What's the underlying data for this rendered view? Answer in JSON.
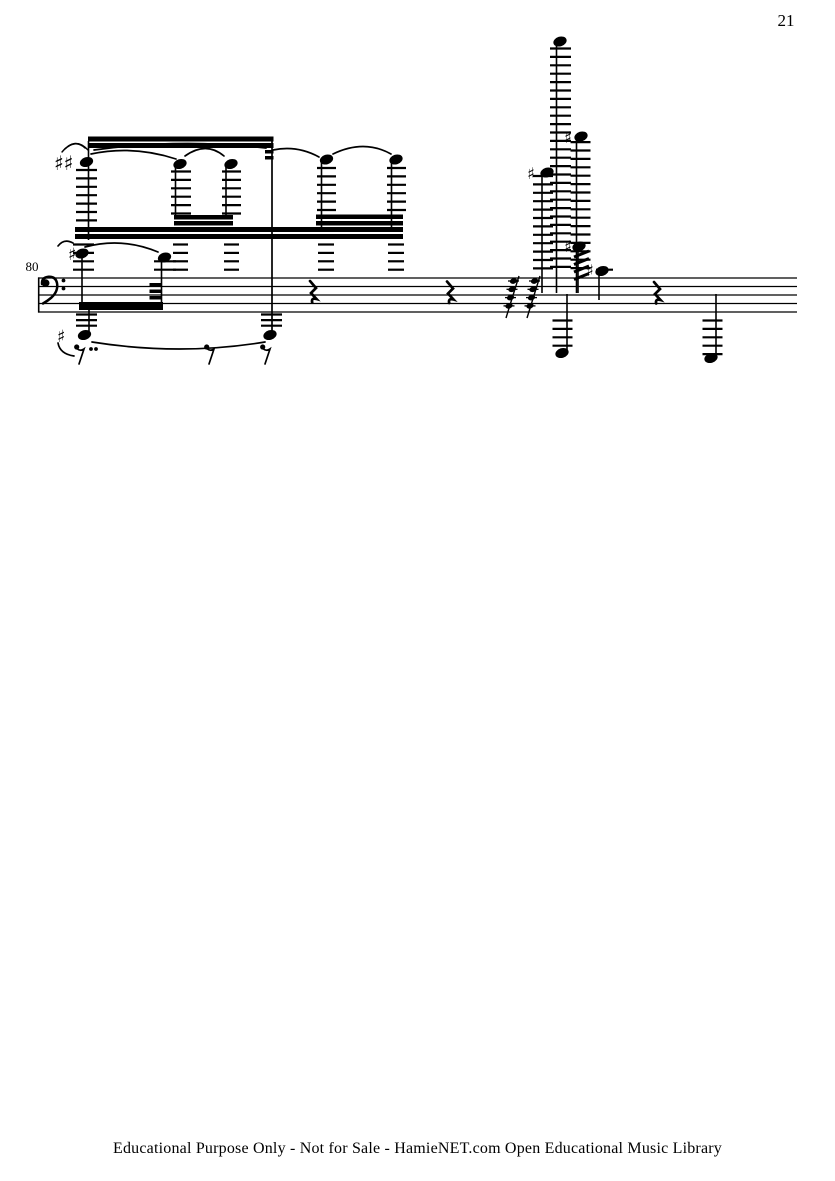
{
  "page": {
    "number": "21",
    "footer": "Educational Purpose Only - Not for Sale - HamieNET.com Open Educational Music Library",
    "background": "#ffffff",
    "ink": "#000000"
  },
  "score": {
    "measure_number": "80",
    "clef": "bass-clef",
    "staff": {
      "x1": 38,
      "x2": 797,
      "line_ys": [
        278,
        286.5,
        295,
        303.5,
        312
      ],
      "lw": 1.2
    },
    "barlines": [
      {
        "x": 38.7,
        "y1": 277.4,
        "y2": 312.6,
        "w": 1.6
      },
      {
        "x": 272,
        "y1": 137,
        "y2": 333,
        "w": 1.7
      }
    ],
    "ladders": [
      {
        "x": 76,
        "w": 21,
        "y1": 170,
        "y2": 221,
        "step": 8.4
      },
      {
        "x": 171,
        "w": 20,
        "y1": 171.5,
        "y2": 214,
        "step": 8.4
      },
      {
        "x": 222,
        "w": 19,
        "y1": 171.5,
        "y2": 214,
        "step": 8.4
      },
      {
        "x": 317,
        "w": 19,
        "y1": 168,
        "y2": 210,
        "step": 8.4
      },
      {
        "x": 387,
        "w": 19,
        "y1": 168,
        "y2": 210,
        "step": 8.4
      },
      {
        "x": 73,
        "w": 21,
        "y1": 244.5,
        "y2": 270,
        "step": 8.4
      },
      {
        "x": 173,
        "w": 15,
        "y1": 244.5,
        "y2": 270,
        "step": 8.4
      },
      {
        "x": 224,
        "w": 15,
        "y1": 244.5,
        "y2": 270,
        "step": 8.4
      },
      {
        "x": 318,
        "w": 16,
        "y1": 244.5,
        "y2": 270,
        "step": 8.4
      },
      {
        "x": 388,
        "w": 16,
        "y1": 244.5,
        "y2": 270,
        "step": 8.4
      },
      {
        "x": 154,
        "w": 22,
        "y1": 261.3,
        "y2": 270,
        "step": 8.4
      },
      {
        "x": 550,
        "w": 21,
        "y1": 48.5,
        "y2": 270,
        "step": 8.4
      },
      {
        "x": 570.5,
        "w": 20,
        "y1": 142.1,
        "y2": 270,
        "step": 8.4
      },
      {
        "x": 533,
        "w": 20,
        "y1": 176,
        "y2": 270,
        "step": 8.4
      },
      {
        "x": 596,
        "w": 17,
        "y1": 269.7,
        "y2": 270,
        "step": 8.4
      },
      {
        "x": 76,
        "w": 21,
        "y1": 314.5,
        "y2": 326,
        "step": 5.6
      },
      {
        "x": 261,
        "w": 21,
        "y1": 314.5,
        "y2": 326,
        "step": 5.6
      },
      {
        "x": 552.5,
        "w": 20,
        "y1": 320.5,
        "y2": 347,
        "step": 8.4
      },
      {
        "x": 702.5,
        "w": 20,
        "y1": 320.5,
        "y2": 355,
        "step": 8.4
      }
    ],
    "stems": [
      {
        "x": 88.5,
        "y1": 141,
        "y2": 240
      },
      {
        "x": 175.5,
        "y1": 166,
        "y2": 217
      },
      {
        "x": 226,
        "y1": 166,
        "y2": 217
      },
      {
        "x": 321.5,
        "y1": 162,
        "y2": 228
      },
      {
        "x": 391.5,
        "y1": 162,
        "y2": 228
      },
      {
        "x": 82,
        "y1": 257,
        "y2": 303
      },
      {
        "x": 161.5,
        "y1": 260,
        "y2": 303
      },
      {
        "x": 89,
        "y1": 307,
        "y2": 331
      },
      {
        "x": 556.5,
        "y1": 44,
        "y2": 293
      },
      {
        "x": 576.5,
        "y1": 140,
        "y2": 293
      },
      {
        "x": 542,
        "y1": 176,
        "y2": 293
      },
      {
        "x": 578,
        "y1": 250,
        "y2": 293
      },
      {
        "x": 599,
        "y1": 274,
        "y2": 300
      },
      {
        "x": 567,
        "y1": 294,
        "y2": 350
      },
      {
        "x": 716,
        "y1": 294,
        "y2": 355
      }
    ],
    "beams": [
      {
        "x": 88,
        "y": 136.5,
        "w": 185.5,
        "h": 5
      },
      {
        "x": 88,
        "y": 143,
        "w": 185.5,
        "h": 5
      },
      {
        "x": 265,
        "y": 150,
        "w": 8.5,
        "h": 3.5
      },
      {
        "x": 265,
        "y": 156,
        "w": 8.5,
        "h": 3.5
      },
      {
        "x": 174,
        "y": 215,
        "w": 59,
        "h": 4.5
      },
      {
        "x": 174,
        "y": 221,
        "w": 59,
        "h": 4.5
      },
      {
        "x": 316,
        "y": 214.5,
        "w": 87,
        "h": 4.5
      },
      {
        "x": 316,
        "y": 221,
        "w": 87,
        "h": 4.5
      },
      {
        "x": 75,
        "y": 227,
        "w": 328,
        "h": 5
      },
      {
        "x": 75,
        "y": 234,
        "w": 328,
        "h": 5
      },
      {
        "x": 79,
        "y": 302,
        "w": 84,
        "h": 8
      },
      {
        "x": 149.5,
        "y": 283,
        "w": 12,
        "h": 3.5
      },
      {
        "x": 149.5,
        "y": 289.5,
        "w": 12,
        "h": 3.5
      },
      {
        "x": 149.5,
        "y": 296,
        "w": 12,
        "h": 3.5
      }
    ],
    "noteheads": [
      {
        "cx": 86.5,
        "cy": 162
      },
      {
        "cx": 180,
        "cy": 164
      },
      {
        "cx": 231,
        "cy": 164
      },
      {
        "cx": 326.5,
        "cy": 159.5
      },
      {
        "cx": 396,
        "cy": 159.5
      },
      {
        "cx": 82,
        "cy": 253.5
      },
      {
        "cx": 164.5,
        "cy": 257.5
      },
      {
        "cx": 84.5,
        "cy": 335
      },
      {
        "cx": 270,
        "cy": 335
      },
      {
        "cx": 560,
        "cy": 41.5
      },
      {
        "cx": 581,
        "cy": 136.5
      },
      {
        "cx": 547,
        "cy": 172.5
      },
      {
        "cx": 579,
        "cy": 246.5
      },
      {
        "cx": 602,
        "cy": 271
      },
      {
        "cx": 562,
        "cy": 353
      },
      {
        "cx": 711,
        "cy": 358
      }
    ],
    "accidentals": [
      {
        "glyph": "♯♯",
        "x": 54,
        "y": 170,
        "size": 20
      },
      {
        "glyph": "♯",
        "x": 68,
        "y": 260,
        "size": 17
      },
      {
        "glyph": "♯",
        "x": 57,
        "y": 342,
        "size": 17
      },
      {
        "glyph": "♯",
        "x": 564,
        "y": 143,
        "size": 16
      },
      {
        "glyph": "♯",
        "x": 527,
        "y": 179,
        "size": 16
      },
      {
        "glyph": "♯",
        "x": 564,
        "y": 252,
        "size": 16
      },
      {
        "glyph": "♯",
        "x": 586,
        "y": 276,
        "size": 16
      }
    ],
    "slurs": [
      "M91 154 Q133 145 176 159",
      "M94 150 Q180 138 266 148",
      "M185 156 Q206 141 224 156",
      "M273 150 Q297 145 319 157",
      "M333 154 Q364 139 391 154",
      "M85 247 Q122 237 158 252",
      "M58 246 Q64 238 73 243",
      "M92 342 Q180 356 265 342",
      "M58 343 Q60 354 74 356"
    ],
    "ornament_arcs": [
      "M62 152 Q75 136 88 150",
      "M65 149 Q75.5 139 85 148",
      "M68 146.5 Q75.5 141.5 82 145.5"
    ],
    "tremolo": {
      "x1": 574,
      "x2": 589,
      "rise": 6,
      "ys": [
        257,
        264.5,
        272,
        279.5
      ],
      "lw": 3
    },
    "grace_runs": [
      {
        "x": 506
      },
      {
        "x": 527
      }
    ],
    "rests": {
      "quarter": [
        {
          "x": 309,
          "y": 281
        },
        {
          "x": 446,
          "y": 281.5
        },
        {
          "x": 653,
          "y": 282
        }
      ],
      "eighth": [
        {
          "x": 74,
          "y": 344,
          "dots": 2
        },
        {
          "x": 204,
          "y": 344,
          "dots": 0
        },
        {
          "x": 260,
          "y": 344,
          "dots": 0
        }
      ]
    }
  }
}
